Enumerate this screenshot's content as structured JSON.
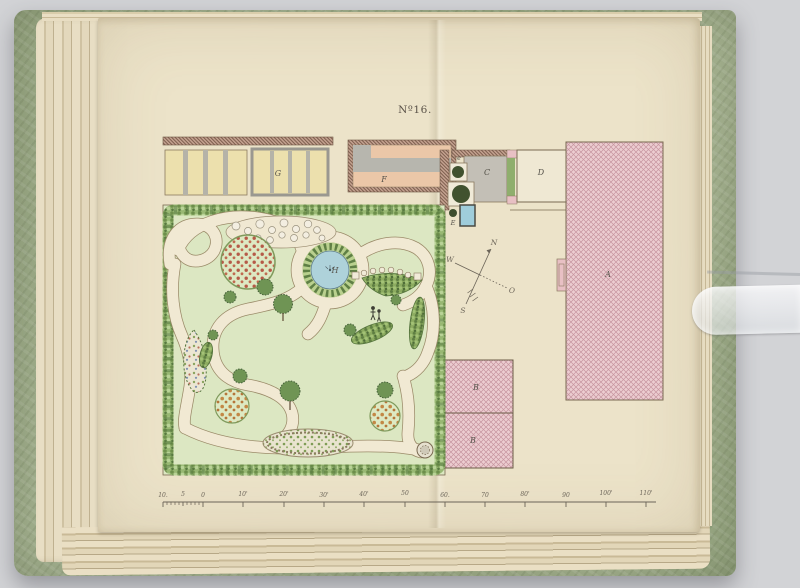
{
  "photo": {
    "background_color": "#d2d3d6"
  },
  "book": {
    "cover_color": "#a8b594",
    "page_color": "#ece3c9"
  },
  "plate": {
    "number": "Nº16.",
    "labels": {
      "frames_g": "G",
      "greenhouse_f": "F",
      "courtyard_c": "C",
      "building_d": "D",
      "tree_e_small": "e",
      "basin_e": "E",
      "mansion_a": "A",
      "outbuilding_b_upper": "B",
      "outbuilding_b_lower": "B",
      "pond_h": "H"
    },
    "compass": {
      "north": "N",
      "west": "W",
      "east": "O",
      "south": "S"
    },
    "scale_bar": {
      "labels": [
        "10.",
        "5",
        "0",
        "10'",
        "20'",
        "30'",
        "40'",
        "50",
        "60.",
        "70",
        "80'",
        "90",
        "100'",
        "110'"
      ]
    },
    "colors": {
      "building_hatch_pink": "#eccdd1",
      "wall_hatch_brown": "#c4a290",
      "water_blue": "#aed2da",
      "lawn_green": "#dce7c2",
      "path_cream": "#f1e9d3",
      "frame_yellow": "#ece0ad"
    }
  }
}
